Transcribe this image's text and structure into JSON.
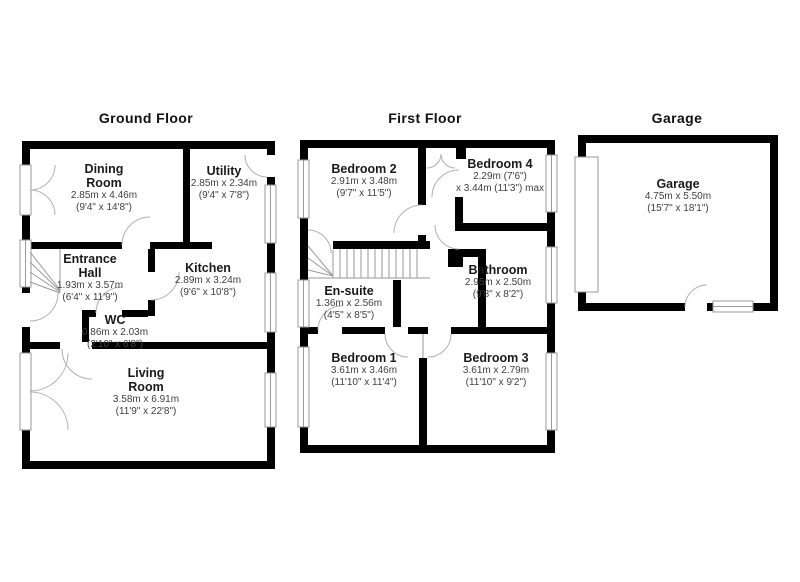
{
  "colors": {
    "wall": "#000000",
    "background": "#ffffff",
    "room_name_text": "#1a1a1a",
    "dimension_text": "#3f3f3f",
    "fixture_line": "#9a9a9a"
  },
  "floors": [
    {
      "title": "Ground Floor",
      "rooms": [
        {
          "name": "Dining Room",
          "dims": [
            "2.85m x 4.46m",
            "(9'4\" x 14'8\")"
          ]
        },
        {
          "name": "Utility",
          "dims": [
            "2.85m x 2.34m",
            "(9'4\" x 7'8\")"
          ]
        },
        {
          "name": "Entrance Hall",
          "dims": [
            "1.93m x 3.57m",
            "(6'4\" x 11'9\")"
          ]
        },
        {
          "name": "Kitchen",
          "dims": [
            "2.89m x 3.24m",
            "(9'6\" x 10'8\")"
          ]
        },
        {
          "name": "WC",
          "dims": [
            "0.86m x 2.03m",
            "(2'10\" x 6'8\")"
          ]
        },
        {
          "name": "Living Room",
          "dims": [
            "3.58m x 6.91m",
            "(11'9\" x 22'8\")"
          ]
        }
      ]
    },
    {
      "title": "First Floor",
      "rooms": [
        {
          "name": "Bedroom 2",
          "dims": [
            "2.91m x 3.48m",
            "(9'7\" x 11'5\")"
          ]
        },
        {
          "name": "Bedroom 4",
          "dims": [
            "2.29m (7'6\")",
            "x 3.44m (11'3\") max"
          ]
        },
        {
          "name": "En-suite",
          "dims": [
            "1.36m x 2.56m",
            "(4'5\" x 8'5\")"
          ]
        },
        {
          "name": "Bathroom",
          "dims": [
            "2.95m x 2.50m",
            "(9'8\" x 8'2\")"
          ]
        },
        {
          "name": "Bedroom 1",
          "dims": [
            "3.61m x 3.46m",
            "(11'10\" x 11'4\")"
          ]
        },
        {
          "name": "Bedroom 3",
          "dims": [
            "3.61m x 2.79m",
            "(11'10\" x 9'2\")"
          ]
        }
      ]
    },
    {
      "title": "Garage",
      "rooms": [
        {
          "name": "Garage",
          "dims": [
            "4.75m x 5.50m",
            "(15'7\" x 18'1\")"
          ]
        }
      ]
    }
  ]
}
